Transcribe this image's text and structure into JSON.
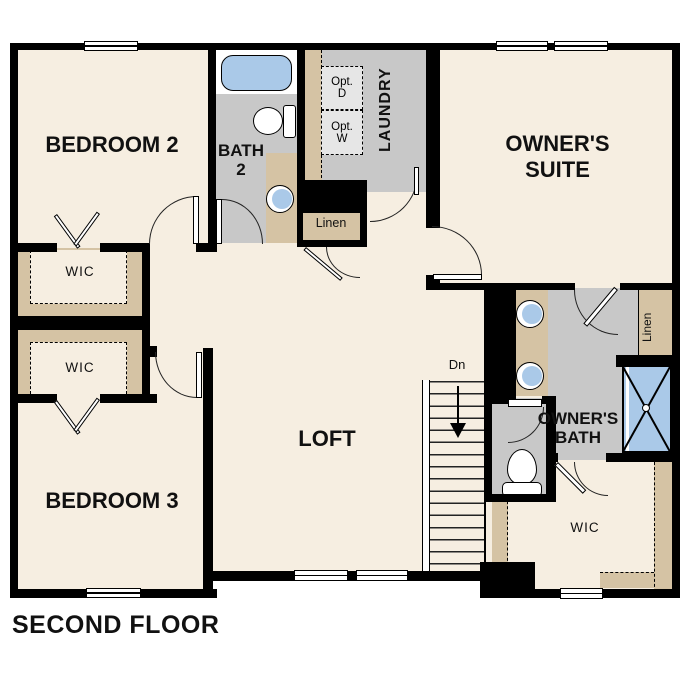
{
  "plan": {
    "floor_title": "SECOND FLOOR",
    "rooms": {
      "bedroom2": "BEDROOM 2",
      "bedroom3": "BEDROOM 3",
      "loft": "LOFT",
      "laundry": "LAUNDRY",
      "owners_suite": {
        "line1": "OWNER'S",
        "line2": "SUITE"
      },
      "bath2": {
        "line1": "BATH",
        "line2": "2"
      },
      "owners_bath": {
        "line1": "OWNER'S",
        "line2": "BATH"
      }
    },
    "closets": {
      "wic_bedroom2": "WIC",
      "wic_bedroom3": "WIC",
      "wic_owners": "WIC",
      "linen_hall": "Linen",
      "linen_owners": "Linen"
    },
    "stairs": {
      "direction": "Dn"
    },
    "laundry_options": {
      "dryer": {
        "line1": "Opt.",
        "line2": "D"
      },
      "washer": {
        "line1": "Opt.",
        "line2": "W"
      }
    },
    "colors": {
      "floor": "#f6eee1",
      "closet_tan": "#d5c3a4",
      "bath_gray": "#c8c8c8",
      "appliance_gray": "#e6e6e6",
      "fixture_blue": "#aac9e8",
      "wall_black": "#000000"
    }
  }
}
